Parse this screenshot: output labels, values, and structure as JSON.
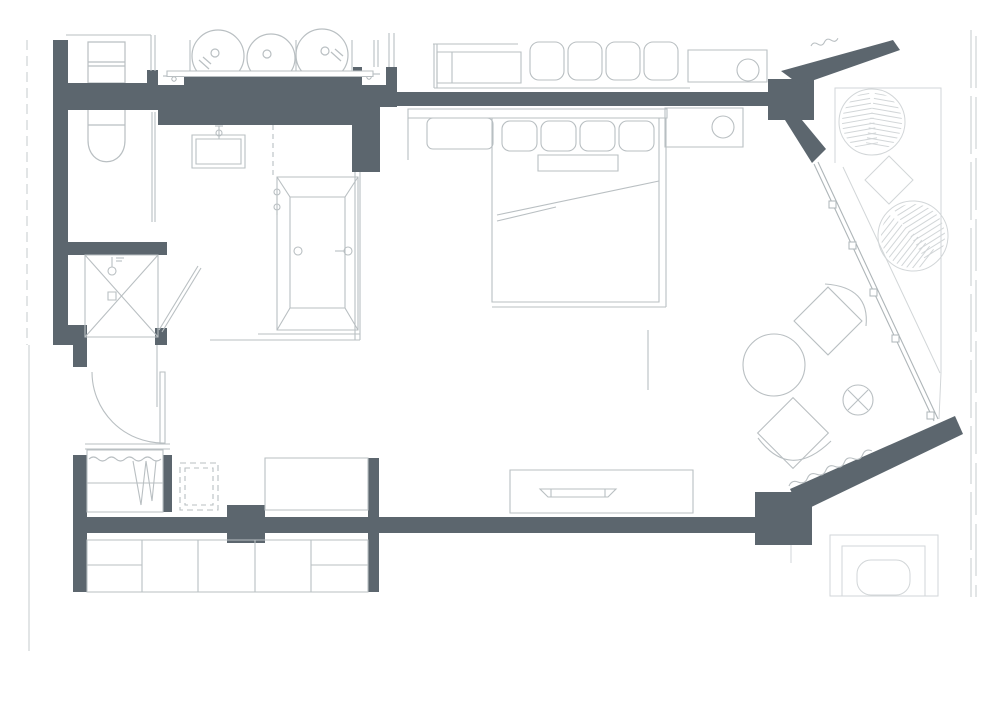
{
  "meta": {
    "type": "architectural-floor-plan",
    "description": "Top-view floor plan of a studio hotel suite with bathroom, bedroom-lounge, entry closet and two balconies behind an angled glazed wall",
    "canvas": {
      "width": 1000,
      "height": 702
    }
  },
  "colors": {
    "background": "#ffffff",
    "wall": "#5c666e",
    "furniture_line": "#b9bfc2",
    "fixture_line": "#aeb5b8",
    "outdoor_line": "#d2d6d8",
    "boundary_line": "#c6cbcd",
    "notch_fill": "#ffffff"
  },
  "plan": {
    "rooms": [
      {
        "name": "bathroom",
        "fixtures": [
          "vanity-counter-3-basins",
          "wall-sink",
          "bathtub",
          "shower-cabin",
          "wc-toilet"
        ]
      },
      {
        "name": "entry-hall",
        "fixtures": [
          "entry-door",
          "wardrobe-closet",
          "dashed-appliance-niche",
          "cabinet",
          "lower-cabinet-row"
        ]
      },
      {
        "name": "bedroom-lounge",
        "fixtures": [
          "double-bed",
          "headboard",
          "bench",
          "nightstand",
          "table-lamp",
          "tv-sideboard",
          "lounge-chair",
          "chaise-chair",
          "round-ottoman",
          "x-side-table",
          "curtain"
        ]
      },
      {
        "name": "balcony-north",
        "fixtures": [
          "wicker-chair",
          "wicker-chair",
          "diamond-table"
        ]
      },
      {
        "name": "balcony-south",
        "fixtures": [
          "outdoor-table"
        ]
      },
      {
        "name": "neighbor-unit",
        "fixtures": [
          "wc-toilet",
          "console",
          "bed-pillows",
          "nightstand",
          "table-lamp"
        ]
      }
    ],
    "counts": {
      "bed_pillows": 4,
      "neighbor_bed_pillows": 4,
      "vanity_basins": 3,
      "glass_mullions": 5,
      "lower_cabinet_sections": 5,
      "balcony_wicker_chairs": 2
    }
  }
}
